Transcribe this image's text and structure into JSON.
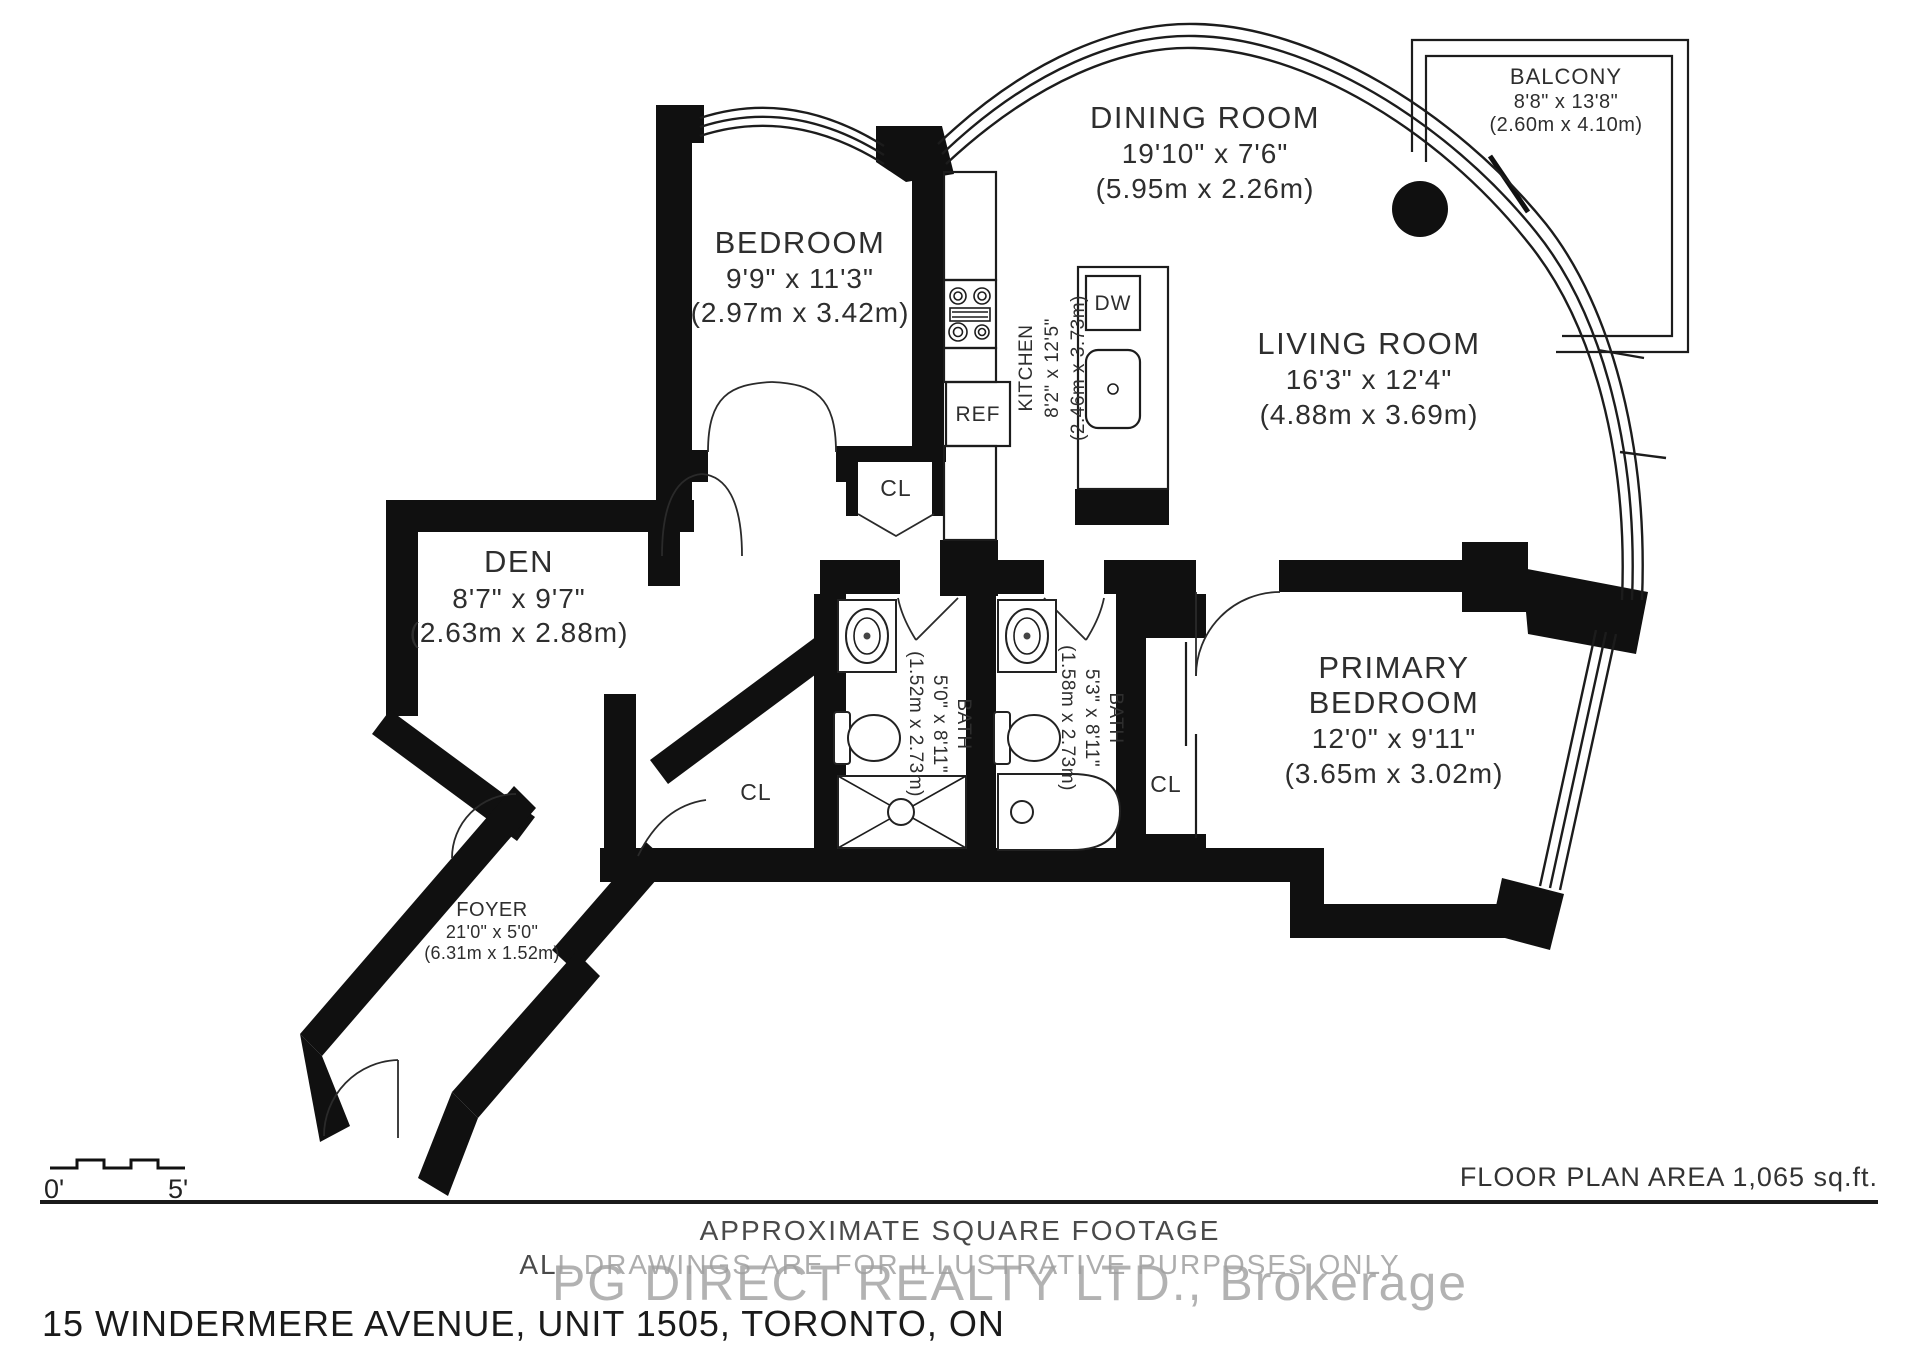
{
  "meta": {
    "area_label": "FLOOR PLAN AREA 1,065 sq.ft.",
    "disclaimer1": "APPROXIMATE SQUARE FOOTAGE",
    "disclaimer2": "ALL DRAWINGS ARE FOR ILLUSTRATIVE PURPOSES ONLY",
    "watermark": "PG DIRECT REALTY LTD., Brokerage",
    "address": "15 WINDERMERE AVENUE, UNIT 1505, TORONTO, ON"
  },
  "scale_bar": {
    "start": "0'",
    "end": "5'"
  },
  "rooms": {
    "bedroom": {
      "name": "BEDROOM",
      "imperial": "9'9\" x 11'3\"",
      "metric": "(2.97m x 3.42m)"
    },
    "dining": {
      "name": "DINING ROOM",
      "imperial": "19'10\" x 7'6\"",
      "metric": "(5.95m x 2.26m)"
    },
    "balcony": {
      "name": "BALCONY",
      "imperial": "8'8\" x 13'8\"",
      "metric": "(2.60m x 4.10m)"
    },
    "living": {
      "name": "LIVING ROOM",
      "imperial": "16'3\" x 12'4\"",
      "metric": "(4.88m x 3.69m)"
    },
    "kitchen": {
      "name": "KITCHEN",
      "imperial": "8'2\" x 12'5\"",
      "metric": "(2.46m x 3.73m)"
    },
    "den": {
      "name": "DEN",
      "imperial": "8'7\" x 9'7\"",
      "metric": "(2.63m x 2.88m)"
    },
    "bath1": {
      "name": "BATH",
      "imperial": "5'0\" x 8'11\"",
      "metric": "(1.52m x 2.73m)"
    },
    "bath2": {
      "name": "BATH",
      "imperial": "5'3\" x 8'11\"",
      "metric": "(1.58m x 2.73m)"
    },
    "primary": {
      "name_line1": "PRIMARY",
      "name_line2": "BEDROOM",
      "imperial": "12'0\" x 9'11\"",
      "metric": "(3.65m x 3.02m)"
    },
    "foyer": {
      "name": "FOYER",
      "imperial": "21'0\" x 5'0\"",
      "metric": "(6.31m x 1.52m)"
    }
  },
  "fixtures": {
    "dishwasher": "DW",
    "refrigerator": "REF",
    "closet": "CL"
  },
  "colors": {
    "walls": "#101010",
    "label_text": "#2e2e2e",
    "muted_text": "#4a4a4a",
    "watermark": "#a0a0a0"
  }
}
